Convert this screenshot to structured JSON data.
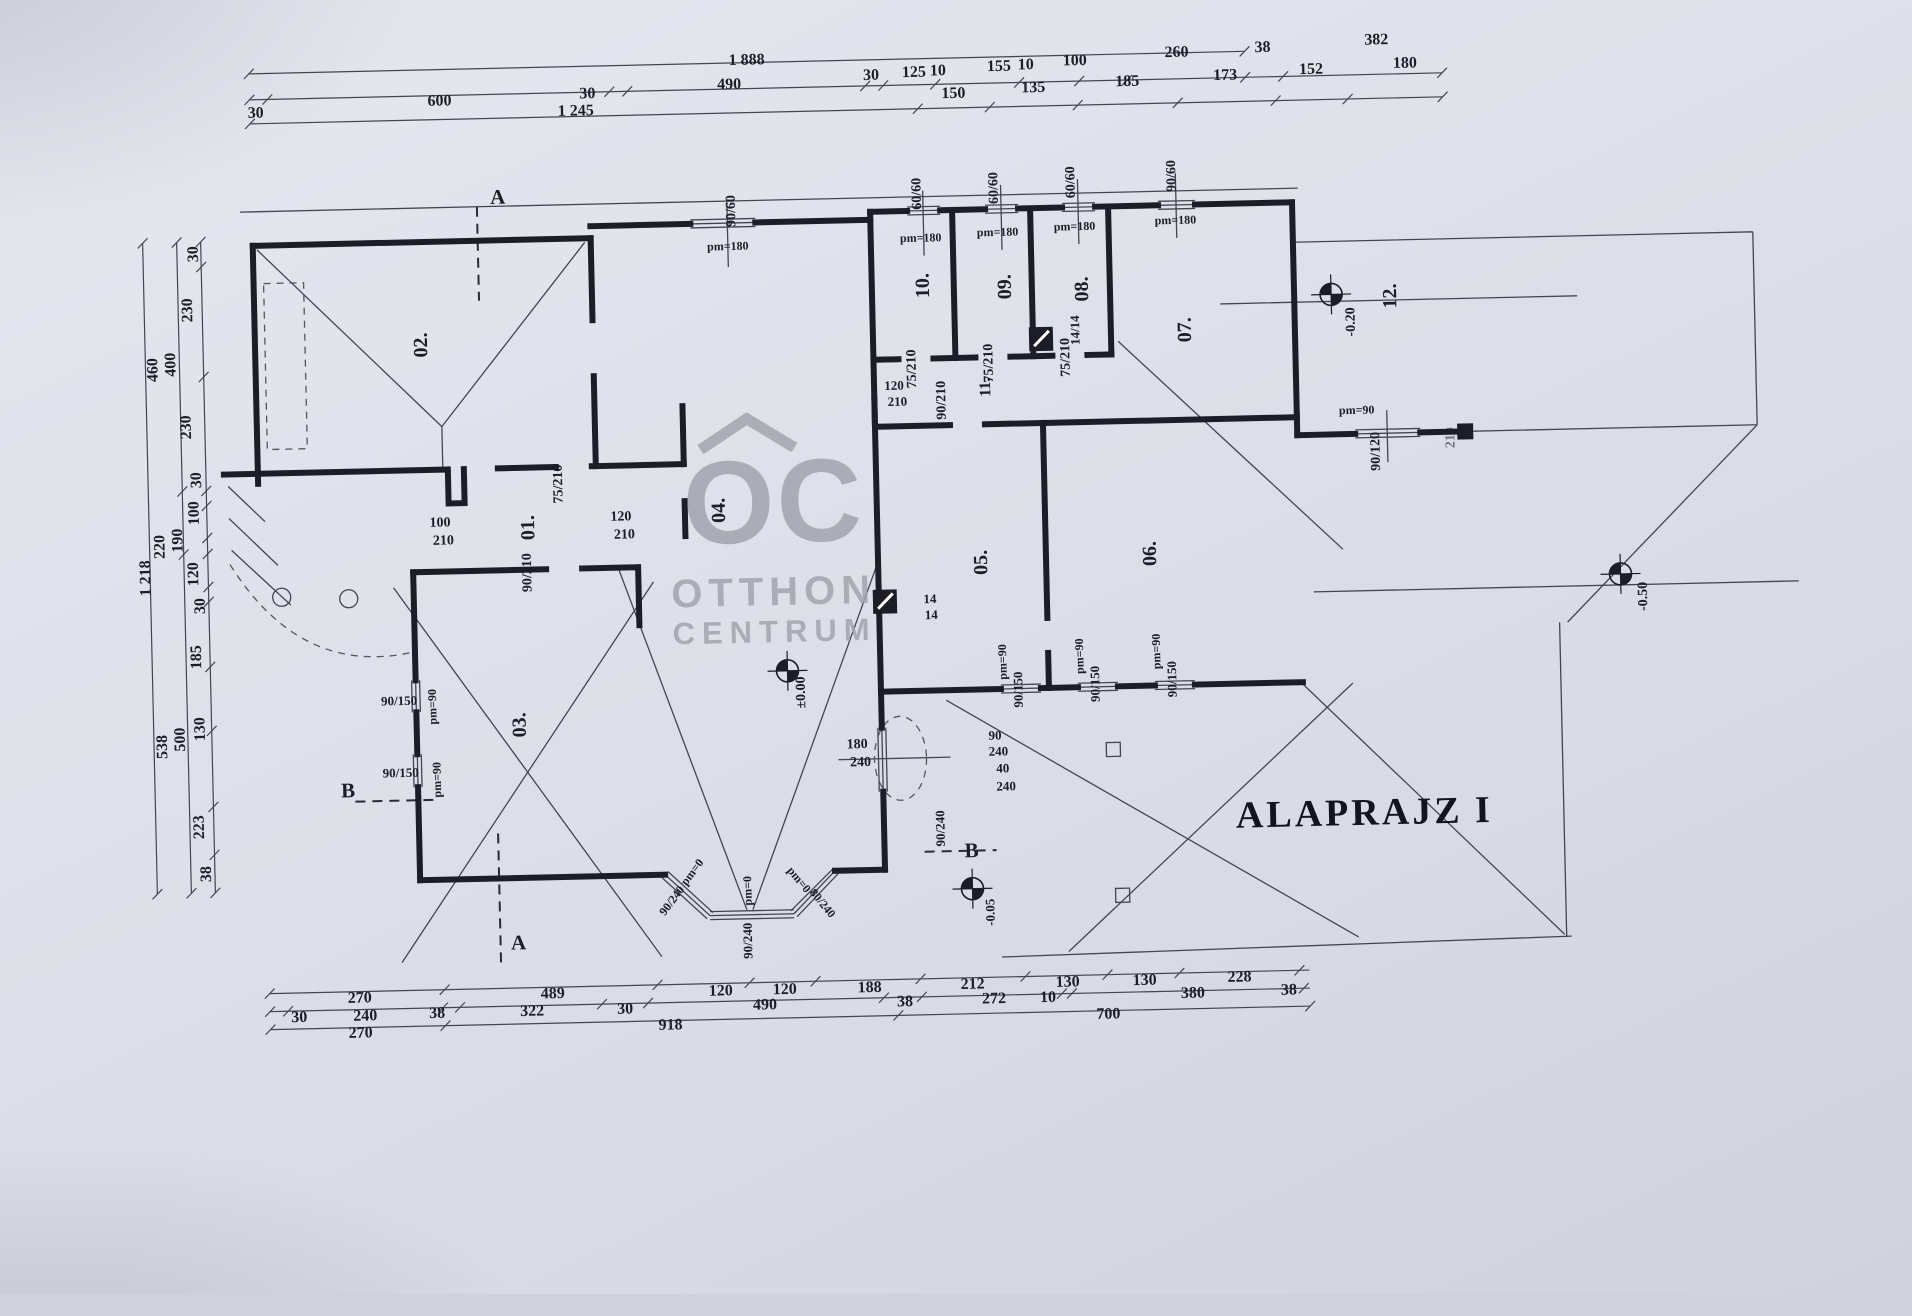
{
  "title": {
    "text": "ALAPRAJZ I"
  },
  "watermark": {
    "logo": "OC",
    "line1": "OTTHON",
    "line2": "CENTRUM"
  },
  "colors": {
    "ink": "#1d1d28",
    "thin_line": "#454552",
    "paper": "#dfe1ea",
    "watermark": "#a3a4ae"
  },
  "rooms": [
    "01.",
    "02.",
    "03.",
    "04.",
    "05.",
    "06.",
    "07.",
    "08.",
    "09.",
    "10.",
    "11.",
    "12."
  ],
  "levels": [
    "±0.00",
    "-0.20",
    "-0.50",
    "-0.05"
  ],
  "benchmarks": [
    {
      "x": 787,
      "y": 667
    },
    {
      "x": 1339,
      "y": 303
    },
    {
      "x": 1622,
      "y": 589
    },
    {
      "x": 967,
      "y": 889
    }
  ],
  "dim_lines": {
    "h": [
      {
        "y": 58,
        "x1": 262,
        "x2": 1258,
        "ticks": [
          262,
          1258
        ]
      },
      {
        "y": 84,
        "x1": 262,
        "x2": 1455,
        "ticks": [
          262,
          280,
          622,
          640,
          878,
          896,
          948,
          1032,
          1092,
          1140,
          1258,
          1296,
          1455
        ]
      },
      {
        "y": 108,
        "x1": 262,
        "x2": 1455,
        "ticks": [
          262,
          930,
          1002,
          1090,
          1190,
          1288,
          1360,
          1455
        ]
      },
      {
        "y": 978,
        "x1": 262,
        "x2": 1302,
        "ticks": [
          262,
          437,
          650,
          742,
          808,
          913,
          1018,
          1100,
          1172,
          1292
        ]
      },
      {
        "y": 996,
        "x1": 262,
        "x2": 1302,
        "ticks": [
          262,
          280,
          435,
          452,
          594,
          640,
          876,
          914,
          1054,
          1064,
          1296
        ]
      },
      {
        "y": 1014,
        "x1": 262,
        "x2": 1302,
        "ticks": [
          262,
          437,
          890,
          1302
        ]
      }
    ],
    "v": [
      {
        "x": 210,
        "y1": 225,
        "y2": 876,
        "ticks": [
          225,
          250,
          360,
          474,
          489,
          521,
          537,
          570,
          585,
          650,
          714,
          790,
          838,
          876
        ]
      },
      {
        "x": 186,
        "y1": 225,
        "y2": 876,
        "ticks": [
          225,
          474,
          537,
          876
        ]
      },
      {
        "x": 152,
        "y1": 225,
        "y2": 876,
        "ticks": [
          225,
          876
        ]
      }
    ]
  },
  "labels": [
    {
      "n": "dim-top",
      "t": "1 888",
      "x": 760,
      "y": 56
    },
    {
      "n": "dim-top",
      "t": "30",
      "x": 268,
      "y": 98
    },
    {
      "n": "dim-top",
      "t": "600",
      "x": 452,
      "y": 90
    },
    {
      "n": "dim-top",
      "t": "30",
      "x": 600,
      "y": 86
    },
    {
      "n": "dim-top",
      "t": "490",
      "x": 742,
      "y": 80
    },
    {
      "n": "dim-top",
      "t": "30",
      "x": 884,
      "y": 74
    },
    {
      "n": "dim-top",
      "t": "125",
      "x": 927,
      "y": 72
    },
    {
      "n": "dim-top",
      "t": "10",
      "x": 951,
      "y": 71
    },
    {
      "n": "dim-top",
      "t": "155",
      "x": 1012,
      "y": 68
    },
    {
      "n": "dim-top",
      "t": "10",
      "x": 1039,
      "y": 67
    },
    {
      "n": "dim-top",
      "t": "100",
      "x": 1088,
      "y": 64
    },
    {
      "n": "dim-top",
      "t": "260",
      "x": 1190,
      "y": 58
    },
    {
      "n": "dim-top",
      "t": "38",
      "x": 1276,
      "y": 55
    },
    {
      "n": "dim-top",
      "t": "382",
      "x": 1390,
      "y": 50
    },
    {
      "n": "dim-top",
      "t": "1 245",
      "x": 588,
      "y": 103
    },
    {
      "n": "dim-top",
      "t": "150",
      "x": 966,
      "y": 94
    },
    {
      "n": "dim-top",
      "t": "135",
      "x": 1046,
      "y": 90
    },
    {
      "n": "dim-top",
      "t": "185",
      "x": 1140,
      "y": 86
    },
    {
      "n": "dim-top",
      "t": "173",
      "x": 1238,
      "y": 82
    },
    {
      "n": "dim-top",
      "t": "152",
      "x": 1324,
      "y": 78
    },
    {
      "n": "dim-top",
      "t": "180",
      "x": 1418,
      "y": 74
    },
    {
      "n": "dim-left",
      "t": "30",
      "x": 203,
      "y": 237,
      "r": -90
    },
    {
      "n": "dim-left",
      "t": "230",
      "x": 196,
      "y": 293,
      "r": -90
    },
    {
      "n": "dim-left",
      "t": "400",
      "x": 178,
      "y": 347,
      "r": -90
    },
    {
      "n": "dim-left",
      "t": "460",
      "x": 160,
      "y": 352,
      "r": -90
    },
    {
      "n": "dim-left",
      "t": "230",
      "x": 192,
      "y": 410,
      "r": -90
    },
    {
      "n": "dim-left",
      "t": "30",
      "x": 201,
      "y": 463,
      "r": -90
    },
    {
      "n": "dim-left",
      "t": "100",
      "x": 198,
      "y": 496,
      "r": -90
    },
    {
      "n": "dim-left",
      "t": "190",
      "x": 181,
      "y": 523,
      "r": -90
    },
    {
      "n": "dim-left",
      "t": "220",
      "x": 163,
      "y": 529,
      "r": -90
    },
    {
      "n": "dim-left",
      "t": "1 218",
      "x": 148,
      "y": 560,
      "r": -90
    },
    {
      "n": "dim-left",
      "t": "120",
      "x": 196,
      "y": 557,
      "r": -90
    },
    {
      "n": "dim-left",
      "t": "30",
      "x": 202,
      "y": 589,
      "r": -90
    },
    {
      "n": "dim-left",
      "t": "185",
      "x": 197,
      "y": 640,
      "r": -90
    },
    {
      "n": "dim-left",
      "t": "130",
      "x": 199,
      "y": 712,
      "r": -90
    },
    {
      "n": "dim-left",
      "t": "500",
      "x": 179,
      "y": 722,
      "r": -90
    },
    {
      "n": "dim-left",
      "t": "538",
      "x": 161,
      "y": 729,
      "r": -90
    },
    {
      "n": "dim-left",
      "t": "223",
      "x": 196,
      "y": 810,
      "r": -90
    },
    {
      "n": "dim-left",
      "t": "38",
      "x": 202,
      "y": 857,
      "r": -90
    },
    {
      "n": "dim-bottom",
      "t": "270",
      "x": 352,
      "y": 985
    },
    {
      "n": "dim-bottom",
      "t": "489",
      "x": 545,
      "y": 985
    },
    {
      "n": "dim-bottom",
      "t": "120",
      "x": 713,
      "y": 986
    },
    {
      "n": "dim-bottom",
      "t": "120",
      "x": 777,
      "y": 986
    },
    {
      "n": "dim-bottom",
      "t": "188",
      "x": 862,
      "y": 986
    },
    {
      "n": "dim-bottom",
      "t": "212",
      "x": 965,
      "y": 985
    },
    {
      "n": "dim-bottom",
      "t": "130",
      "x": 1060,
      "y": 985
    },
    {
      "n": "dim-bottom",
      "t": "130",
      "x": 1137,
      "y": 985
    },
    {
      "n": "dim-bottom",
      "t": "228",
      "x": 1232,
      "y": 984
    },
    {
      "n": "dim-bottom",
      "t": "30",
      "x": 291,
      "y": 1003
    },
    {
      "n": "dim-bottom",
      "t": "240",
      "x": 357,
      "y": 1003
    },
    {
      "n": "dim-bottom",
      "t": "38",
      "x": 429,
      "y": 1002
    },
    {
      "n": "dim-bottom",
      "t": "322",
      "x": 524,
      "y": 1002
    },
    {
      "n": "dim-bottom",
      "t": "30",
      "x": 617,
      "y": 1002
    },
    {
      "n": "dim-bottom",
      "t": "490",
      "x": 757,
      "y": 1001
    },
    {
      "n": "dim-bottom",
      "t": "38",
      "x": 897,
      "y": 1001
    },
    {
      "n": "dim-bottom",
      "t": "272",
      "x": 986,
      "y": 1000
    },
    {
      "n": "dim-bottom",
      "t": "10",
      "x": 1040,
      "y": 1000
    },
    {
      "n": "dim-bottom",
      "t": "380",
      "x": 1185,
      "y": 999
    },
    {
      "n": "dim-bottom",
      "t": "38",
      "x": 1281,
      "y": 998
    },
    {
      "n": "dim-bottom",
      "t": "270",
      "x": 352,
      "y": 1020
    },
    {
      "n": "dim-bottom",
      "t": "918",
      "x": 662,
      "y": 1019
    },
    {
      "n": "dim-bottom",
      "t": "700",
      "x": 1100,
      "y": 1018
    },
    {
      "n": "room-01",
      "t": "01.",
      "x": 531,
      "y": 518,
      "r": -90,
      "s": 20
    },
    {
      "n": "room-02",
      "t": "02.",
      "x": 428,
      "y": 333,
      "r": -90,
      "s": 20
    },
    {
      "n": "room-03",
      "t": "03.",
      "x": 518,
      "y": 715,
      "r": -90,
      "s": 20
    },
    {
      "n": "room-04",
      "t": "04.",
      "x": 722,
      "y": 505,
      "r": -90,
      "s": 20
    },
    {
      "n": "room-05",
      "t": "05.",
      "x": 983,
      "y": 563,
      "r": -90,
      "s": 20
    },
    {
      "n": "room-06",
      "t": "06.",
      "x": 1152,
      "y": 558,
      "r": -90,
      "s": 20
    },
    {
      "n": "room-07",
      "t": "07.",
      "x": 1192,
      "y": 335,
      "r": -90,
      "s": 20
    },
    {
      "n": "room-08",
      "t": "08.",
      "x": 1090,
      "y": 292,
      "r": -90,
      "s": 20
    },
    {
      "n": "room-09",
      "t": "09.",
      "x": 1013,
      "y": 288,
      "r": -90,
      "s": 20
    },
    {
      "n": "room-10",
      "t": "10.",
      "x": 931,
      "y": 285,
      "r": -90,
      "s": 20
    },
    {
      "n": "room-11",
      "t": "11.",
      "x": 992,
      "y": 388,
      "r": -90,
      "s": 16
    },
    {
      "n": "room-12",
      "t": "12.",
      "x": 1398,
      "y": 306,
      "r": -90,
      "s": 20
    },
    {
      "n": "window-size",
      "t": "90/60",
      "x": 742,
      "y": 206,
      "r": -90,
      "s": 14
    },
    {
      "n": "parapet",
      "t": "pm=180",
      "x": 737,
      "y": 241,
      "s": 12
    },
    {
      "n": "window-size",
      "t": "60/60",
      "x": 928,
      "y": 193,
      "r": -90,
      "s": 14
    },
    {
      "n": "parapet",
      "t": "pm=180",
      "x": 930,
      "y": 237,
      "s": 12
    },
    {
      "n": "window-size",
      "t": "60/60",
      "x": 1005,
      "y": 189,
      "r": -90,
      "s": 14
    },
    {
      "n": "parapet",
      "t": "pm=180",
      "x": 1007,
      "y": 233,
      "s": 12
    },
    {
      "n": "window-size",
      "t": "60/60",
      "x": 1082,
      "y": 185,
      "r": -90,
      "s": 14
    },
    {
      "n": "parapet",
      "t": "pm=180",
      "x": 1084,
      "y": 229,
      "s": 12
    },
    {
      "n": "window-size",
      "t": "90/60",
      "x": 1183,
      "y": 181,
      "r": -90,
      "s": 14
    },
    {
      "n": "parapet",
      "t": "pm=180",
      "x": 1185,
      "y": 225,
      "s": 12
    },
    {
      "n": "parapet",
      "t": "pm=90",
      "x": 1362,
      "y": 419,
      "s": 12
    },
    {
      "n": "window-size",
      "t": "90/120",
      "x": 1381,
      "y": 461,
      "r": -90,
      "s": 14
    },
    {
      "n": "window-size",
      "t": "210",
      "x": 1456,
      "y": 449,
      "r": -90,
      "s": 14,
      "c": "faint"
    },
    {
      "n": "window-size",
      "t": "90/150",
      "x": 398,
      "y": 688,
      "s": 13
    },
    {
      "n": "parapet",
      "t": "pm=90",
      "x": 431,
      "y": 695,
      "r": -90,
      "s": 12
    },
    {
      "n": "window-size",
      "t": "90/150",
      "x": 398,
      "y": 760,
      "s": 13
    },
    {
      "n": "parapet",
      "t": "pm=90",
      "x": 434,
      "y": 768,
      "r": -90,
      "s": 12
    },
    {
      "n": "parapet",
      "t": "pm=90",
      "x": 1002,
      "y": 663,
      "r": -90,
      "s": 12
    },
    {
      "n": "window-size",
      "t": "90/150",
      "x": 1017,
      "y": 691,
      "r": -90,
      "s": 13
    },
    {
      "n": "parapet",
      "t": "pm=90",
      "x": 1079,
      "y": 659,
      "r": -90,
      "s": 12
    },
    {
      "n": "window-size",
      "t": "90/150",
      "x": 1094,
      "y": 687,
      "r": -90,
      "s": 13
    },
    {
      "n": "parapet",
      "t": "pm=90",
      "x": 1156,
      "y": 656,
      "r": -90,
      "s": 12
    },
    {
      "n": "window-size",
      "t": "90/150",
      "x": 1171,
      "y": 684,
      "r": -90,
      "s": 13
    },
    {
      "n": "door-size",
      "t": "75/210",
      "x": 563,
      "y": 475,
      "r": -90,
      "s": 14
    },
    {
      "n": "door-size",
      "t": "100",
      "x": 443,
      "y": 512,
      "s": 14
    },
    {
      "n": "door-size",
      "t": "210",
      "x": 446,
      "y": 530,
      "s": 14
    },
    {
      "n": "door-size",
      "t": "120",
      "x": 624,
      "y": 510,
      "s": 14
    },
    {
      "n": "door-size",
      "t": "210",
      "x": 627,
      "y": 528,
      "s": 14
    },
    {
      "n": "door-size",
      "t": "90/210",
      "x": 530,
      "y": 563,
      "r": -90,
      "s": 14
    },
    {
      "n": "door-size",
      "t": "75/210",
      "x": 919,
      "y": 368,
      "r": -90,
      "s": 14
    },
    {
      "n": "door-size",
      "t": "75/210",
      "x": 996,
      "y": 364,
      "r": -90,
      "s": 14
    },
    {
      "n": "door-size",
      "t": "75/210",
      "x": 1073,
      "y": 360,
      "r": -90,
      "s": 14
    },
    {
      "n": "door-size",
      "t": "120",
      "x": 900,
      "y": 384,
      "s": 13
    },
    {
      "n": "door-size",
      "t": "210",
      "x": 903,
      "y": 400,
      "s": 13
    },
    {
      "n": "door-size",
      "t": "90/210",
      "x": 948,
      "y": 400,
      "r": -90,
      "s": 14
    },
    {
      "n": "flue-size",
      "t": "14/14",
      "x": 1082,
      "y": 333,
      "r": -90,
      "s": 13
    },
    {
      "n": "flue-size",
      "t": "14",
      "x": 931,
      "y": 598,
      "s": 13
    },
    {
      "n": "flue-size",
      "t": "14",
      "x": 932,
      "y": 614,
      "s": 13
    },
    {
      "n": "door-size",
      "t": "90",
      "x": 993,
      "y": 736,
      "s": 13
    },
    {
      "n": "door-size",
      "t": "240",
      "x": 996,
      "y": 752,
      "s": 13
    },
    {
      "n": "door-size",
      "t": "40",
      "x": 1000,
      "y": 769,
      "s": 13
    },
    {
      "n": "door-size",
      "t": "240",
      "x": 1003,
      "y": 787,
      "s": 13
    },
    {
      "n": "window-size",
      "t": "180",
      "x": 855,
      "y": 743,
      "s": 14
    },
    {
      "n": "window-size",
      "t": "240",
      "x": 858,
      "y": 761,
      "s": 14
    },
    {
      "n": "door-size",
      "t": "90/240",
      "x": 936,
      "y": 828,
      "r": -90,
      "s": 13
    },
    {
      "n": "section-mark",
      "t": "B",
      "x": 967,
      "y": 851,
      "s": 21
    },
    {
      "n": "section-mark",
      "t": "B",
      "x": 345,
      "y": 777,
      "s": 21
    },
    {
      "n": "section-mark",
      "t": "A",
      "x": 508,
      "y": 187,
      "s": 21
    },
    {
      "n": "section-mark",
      "t": "A",
      "x": 512,
      "y": 933,
      "s": 21
    },
    {
      "n": "level",
      "t": "±0.00",
      "x": 801,
      "y": 689,
      "r": -90,
      "s": 14
    },
    {
      "n": "level",
      "t": "-0.20",
      "x": 1359,
      "y": 331,
      "r": -90,
      "s": 14
    },
    {
      "n": "level",
      "t": "-0.50",
      "x": 1645,
      "y": 612,
      "r": -90,
      "s": 14
    },
    {
      "n": "level",
      "t": "-0.05",
      "x": 984,
      "y": 913,
      "r": -90,
      "s": 13
    },
    {
      "n": "parapet",
      "t": "pm=0",
      "x": 687,
      "y": 866,
      "r": -52,
      "s": 12
    },
    {
      "n": "window-size",
      "t": "90/240",
      "x": 666,
      "y": 894,
      "r": -52,
      "s": 12
    },
    {
      "n": "parapet",
      "t": "pm=0",
      "x": 742,
      "y": 886,
      "r": -90,
      "s": 12
    },
    {
      "n": "window-size",
      "t": "90/240",
      "x": 741,
      "y": 936,
      "r": -90,
      "s": 13
    },
    {
      "n": "parapet",
      "t": "pm=0",
      "x": 794,
      "y": 876,
      "r": 52,
      "s": 12
    },
    {
      "n": "window-size",
      "t": "80/240",
      "x": 817,
      "y": 900,
      "r": 52,
      "s": 12
    }
  ]
}
